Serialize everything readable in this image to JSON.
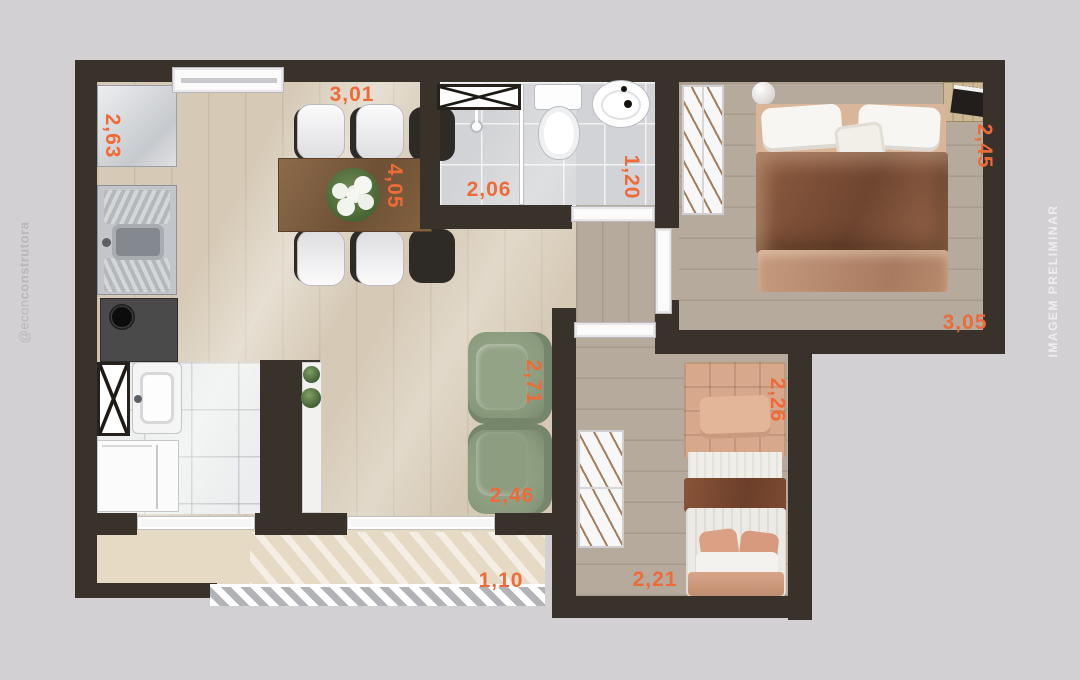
{
  "watermark_left": {
    "prefix": "@econ",
    "bold": "construtora"
  },
  "watermark_right": {
    "text": "IMAGEM PRELIMINAR"
  },
  "dimensions": {
    "kitchen_depth": "2,63",
    "dining_width": "3,01",
    "dining_length": "4,05",
    "bathroom_width": "2,06",
    "bathroom_depth": "1,20",
    "bedroom1_depth": "2,45",
    "bedroom1_width": "3,05",
    "living_depth": "2,71",
    "living_width": "2,46",
    "bedroom2_depth": "2,26",
    "bedroom2_width": "2,21",
    "balcony_depth": "1,10"
  },
  "colors": {
    "background": "#d2d0d3",
    "wall": "#39322b",
    "dim_label": "#ee6b39",
    "wood_light": "#d6cab6",
    "wood_gray": "#b6aa9c",
    "tile_bath": "#d2d3d6",
    "tile_service": "#ebedee",
    "balcony_floor": "#e7dac4",
    "sofa_green": "#8a9b7d",
    "bed_brown": "#8d5c40",
    "watermark_left": "#b8b6b9",
    "watermark_right": "#efedf0"
  }
}
